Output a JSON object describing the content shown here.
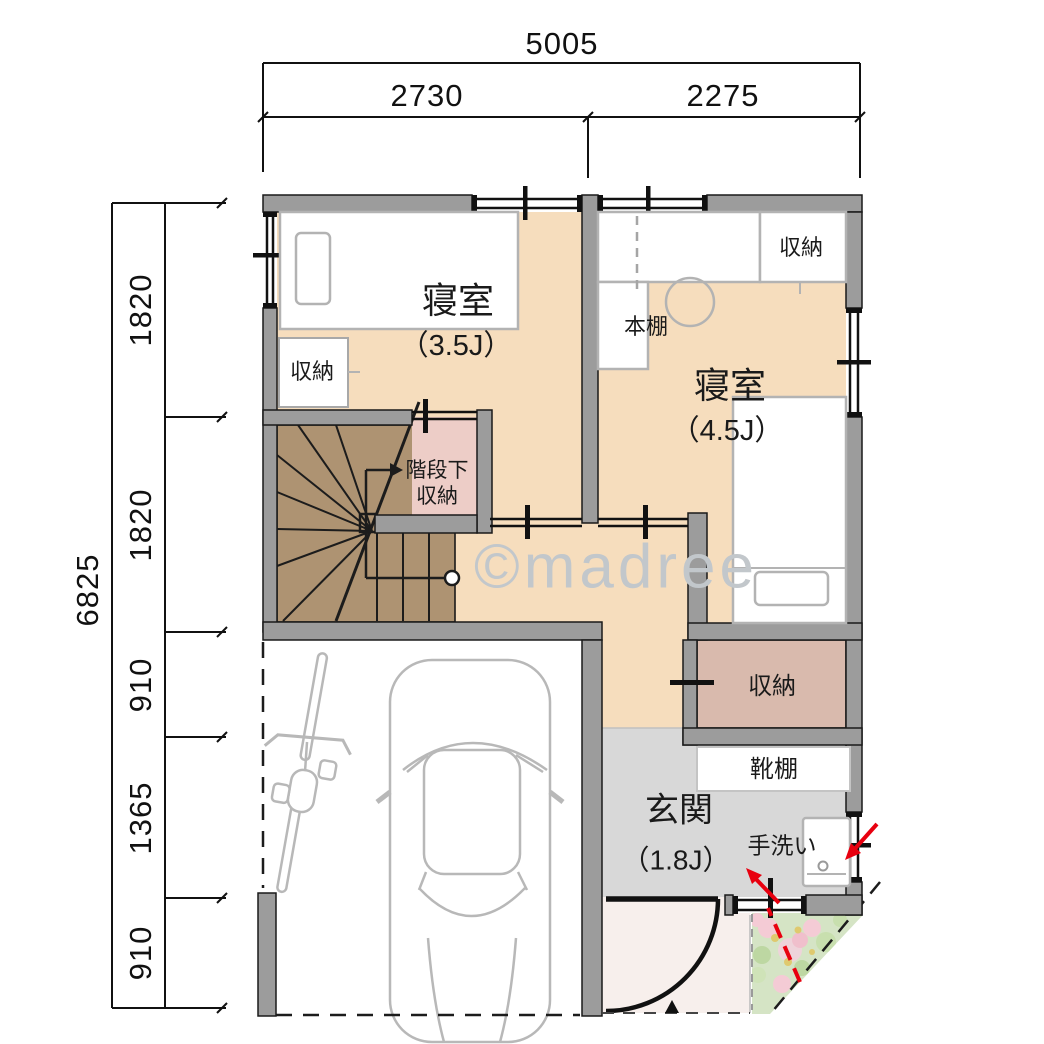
{
  "watermark": "©madree",
  "dimensions": {
    "top": {
      "total": "5005",
      "segments": [
        "2730",
        "2275"
      ]
    },
    "left": {
      "total": "6825",
      "segments": [
        "1820",
        "1820",
        "910",
        "1365",
        "910"
      ]
    }
  },
  "labels": {
    "bedroom35_name": "寝室",
    "bedroom35_size": "（3.5J）",
    "bedroom35_closet": "収納",
    "bedroom45_name": "寝室",
    "bedroom45_size": "（4.5J）",
    "bedroom45_closet": "収納",
    "bookshelf": "本棚",
    "stair_storage_line1": "階段下",
    "stair_storage_line2": "収納",
    "mid_storage": "収納",
    "shoe_shelf": "靴棚",
    "entrance_name": "玄関",
    "entrance_size": "（1.8J）",
    "hand_wash": "手洗い"
  },
  "colors": {
    "wall": "#9c9c9c",
    "floor_tan": "#f6ddbd",
    "stairs_brown": "#ae9372",
    "storage_pink": "#edcdc7",
    "storage_mauve": "#d9baad",
    "entrance_gray": "#d8d8d8",
    "porch_pink": "#f7efec",
    "garden_green": "#d5e4c5",
    "route_red": "#e8000f",
    "furniture_gray": "#b3b3b3",
    "watermark_gray": "#c2c7cb"
  }
}
